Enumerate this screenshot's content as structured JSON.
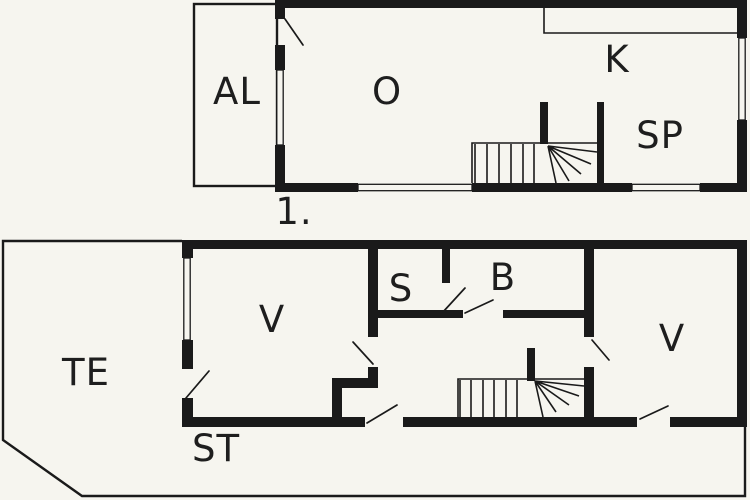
{
  "colors": {
    "wall": "#1a1a1a",
    "line": "#1a1a1a",
    "text": "#1e1e1e",
    "background": "#f6f5ef"
  },
  "upper_floor": {
    "caption": "1.",
    "labels": {
      "al": "AL",
      "o": "O",
      "k": "K",
      "sp": "SP"
    }
  },
  "lower_floor": {
    "labels": {
      "te": "TE",
      "v_left": "V",
      "s": "S",
      "b": "B",
      "v_right": "V",
      "st": "ST"
    }
  }
}
